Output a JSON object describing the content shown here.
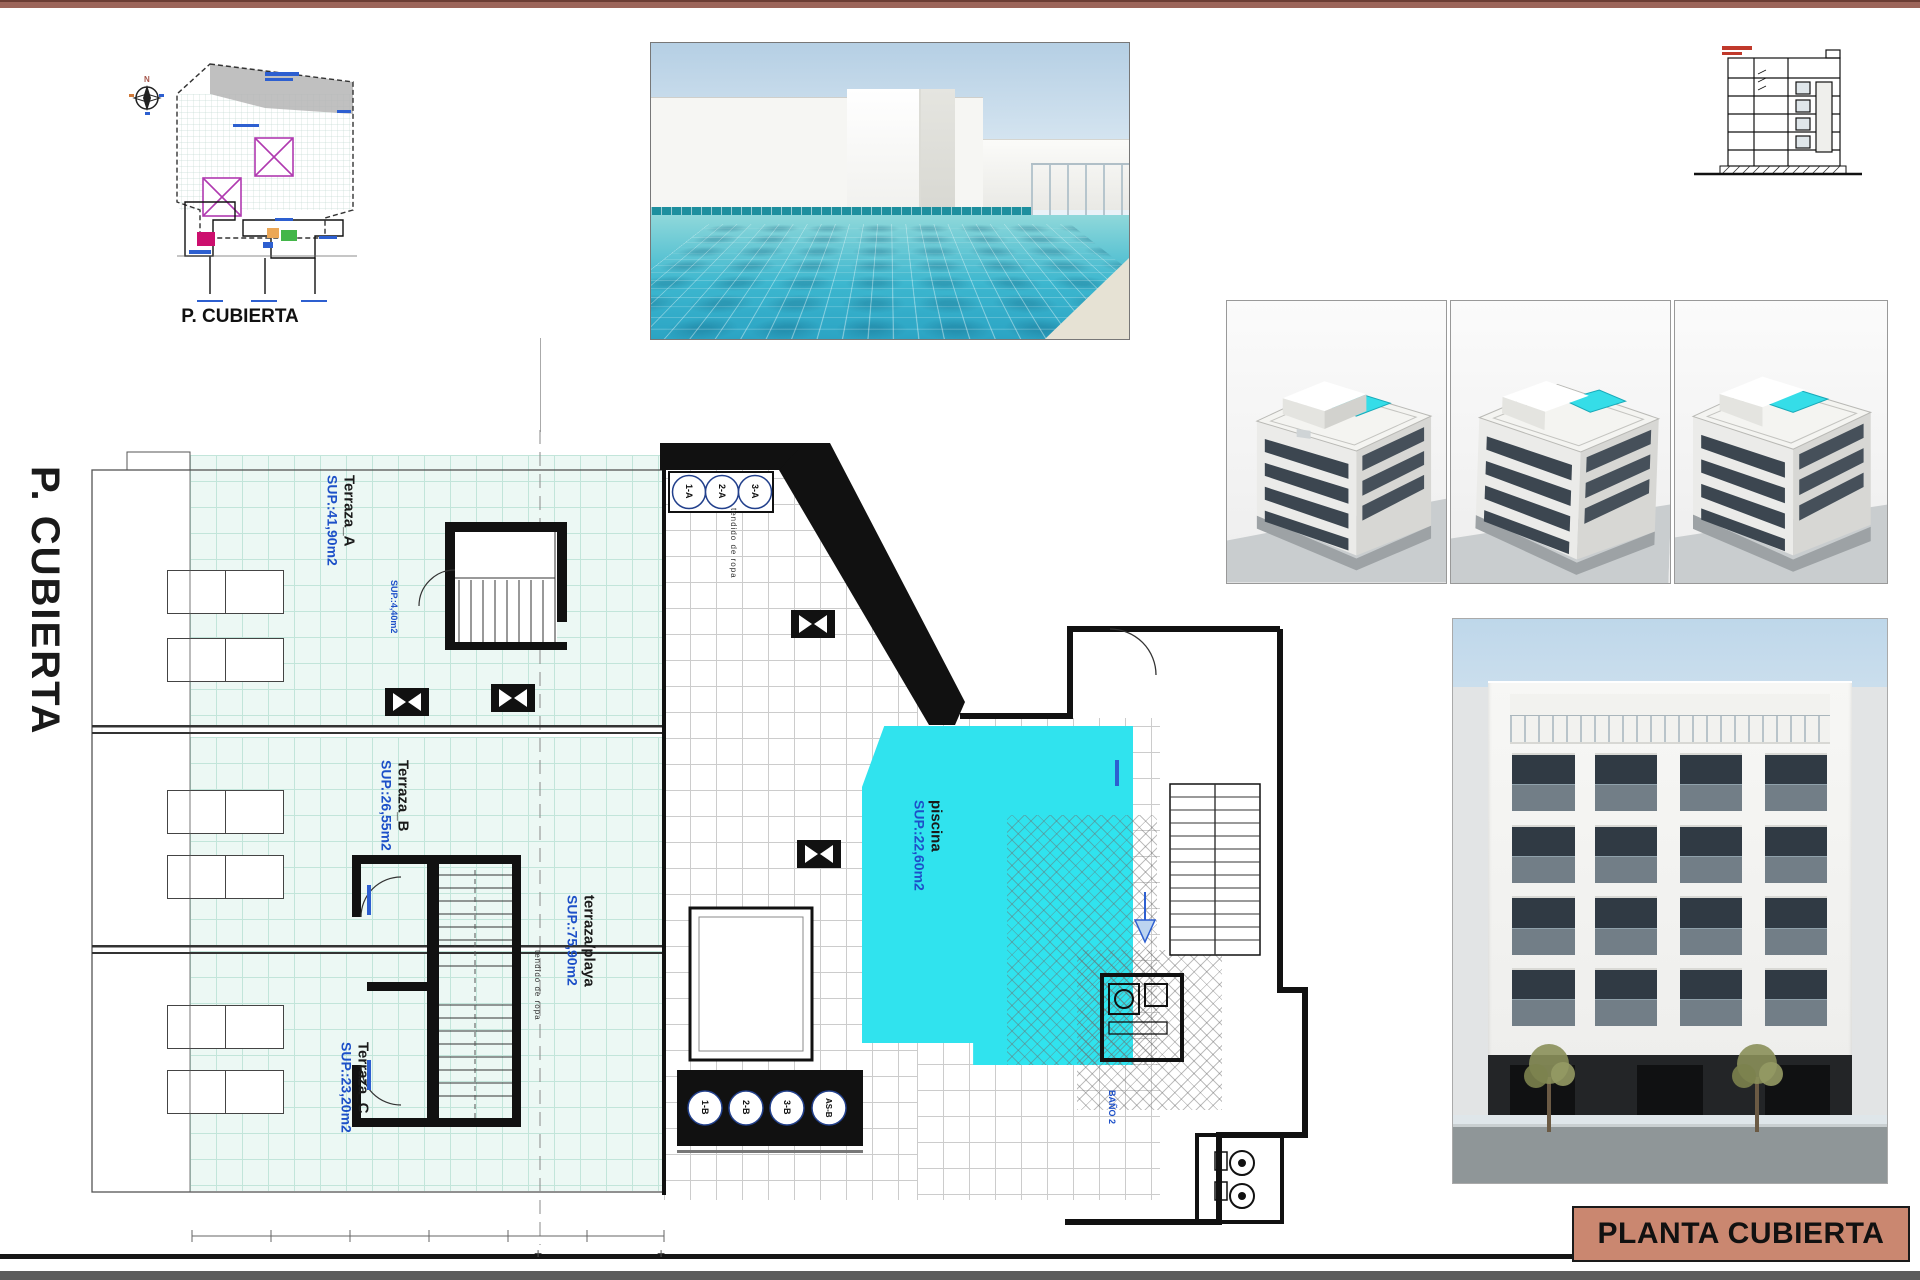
{
  "sheet": {
    "side_title": "P. CUBIERTA",
    "title_block": {
      "label": "PLANTA CUBIERTA",
      "bg": "#ca8770"
    },
    "top_bar_color": "#9c655a"
  },
  "key_plan": {
    "caption": "P. CUBIERTA"
  },
  "compass": {
    "n": "N",
    "s": "S",
    "e": "E",
    "o": "O",
    "ne": "NE",
    "no": "NO",
    "se": "SE",
    "so": "SO"
  },
  "plan": {
    "terraces": [
      {
        "name": "Terraza_A",
        "sup": "SUP.:41,90m2"
      },
      {
        "name": "Terraza_B",
        "sup": "SUP.:26,55m2"
      },
      {
        "name": "Terraza_C",
        "sup": "SUP.:23,20m2"
      }
    ],
    "beach_terrace": {
      "name": "terraza/playa",
      "sup": "SUP.:75,90m2"
    },
    "pool": {
      "name": "piscina",
      "sup": "SUP.:22,60m2",
      "color": "#30e3ee"
    },
    "clothesline_label": "tendido de ropa",
    "stair_sup_label": "SUP.:4,40m2",
    "bath_label": "BAÑO 2",
    "stair_circles_top": [
      "1-A",
      "2-A",
      "3-A"
    ],
    "stair_circles_bottom": [
      "1-B",
      "2-B",
      "3-B",
      "AS-B"
    ]
  }
}
